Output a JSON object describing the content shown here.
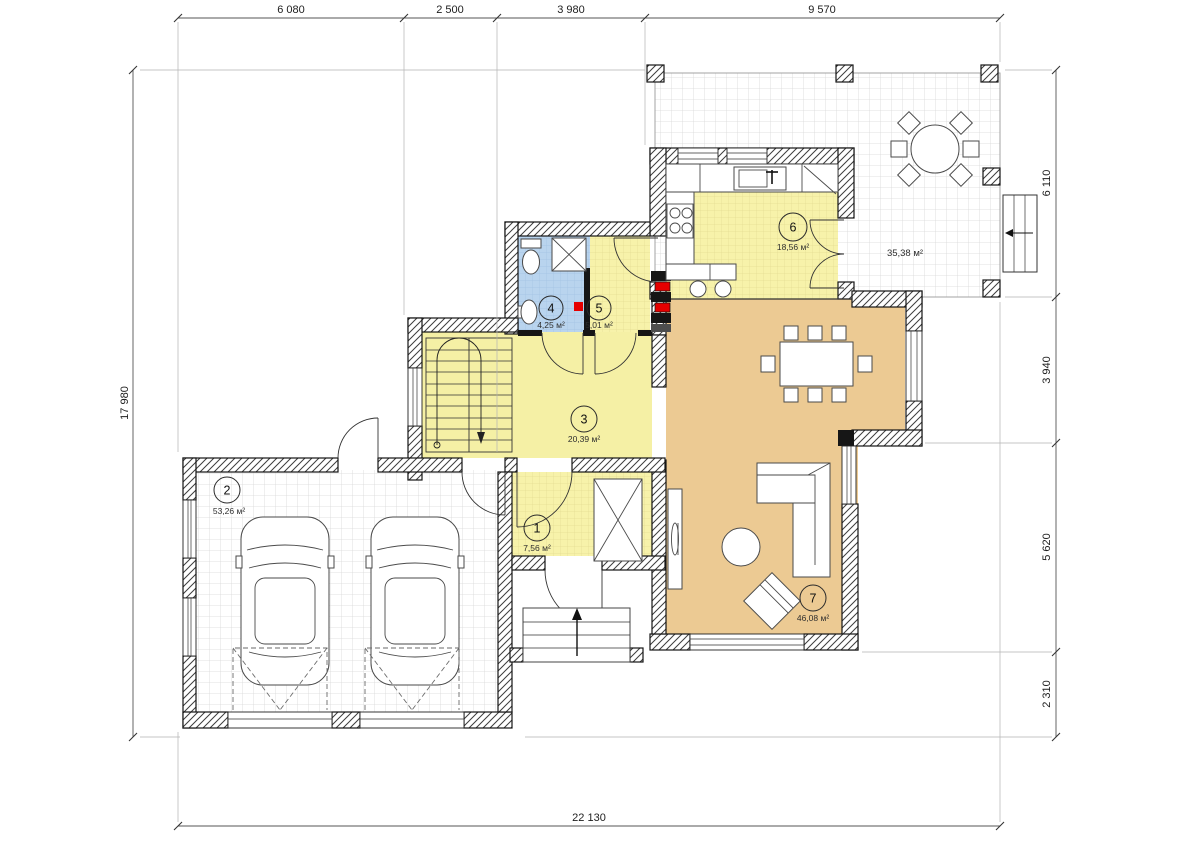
{
  "title": "Ground floor plan",
  "dimensions": {
    "top": [
      "6 080",
      "2 500",
      "3 980",
      "9 570"
    ],
    "right": [
      "6 110",
      "3 940",
      "5 620",
      "2 310"
    ],
    "left": [
      "17 980"
    ],
    "bottom": [
      "22 130"
    ]
  },
  "rooms": [
    {
      "number": "1",
      "area": "7,56 м²"
    },
    {
      "number": "2",
      "area": "53,26 м²"
    },
    {
      "number": "3",
      "area": "20,39 м²"
    },
    {
      "number": "4",
      "area": "4,25 м²"
    },
    {
      "number": "5",
      "area": "5,01 м²"
    },
    {
      "number": "6",
      "area": "18,56 м²"
    },
    {
      "number": "7",
      "area": "46,08 м²"
    }
  ],
  "terrace": {
    "area": "35,38 м²"
  },
  "colors": {
    "room_yellow": "#f7f2aa",
    "room_yellow_plain": "#f5f0a5",
    "room_blue": "#b9d4ee",
    "room_tan": "#ecca93",
    "accent_red": "#e60000",
    "wall": "#161616",
    "grid": "#d7d7d7"
  }
}
